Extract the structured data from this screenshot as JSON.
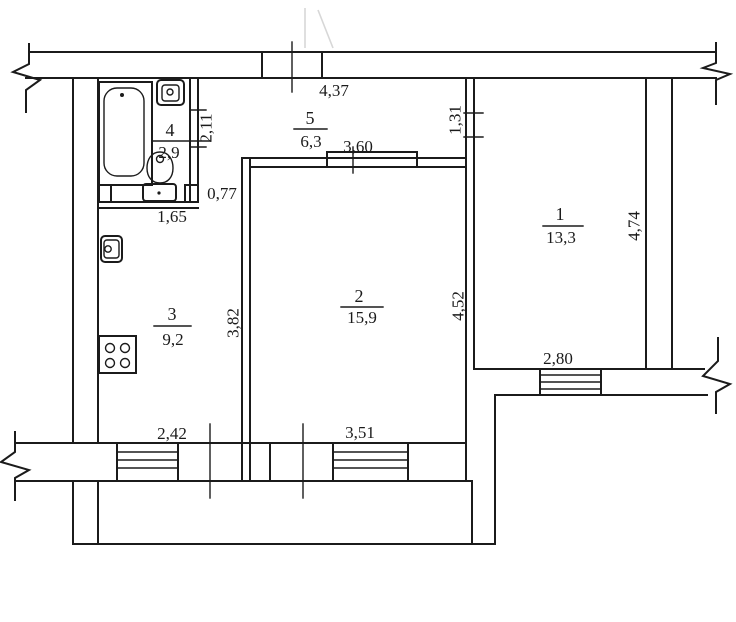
{
  "plan": {
    "type": "apartment-floor-plan",
    "rooms": {
      "room1": {
        "number": "1",
        "area": "13,3"
      },
      "room2": {
        "number": "2",
        "area": "15,9"
      },
      "room3": {
        "number": "3",
        "area": "9,2"
      },
      "room4": {
        "number": "4",
        "area": "2,9"
      },
      "room5": {
        "number": "5",
        "area": "6,3"
      }
    },
    "dims": {
      "entry_width": "4,37",
      "hall_room2_opening": "3,60",
      "room1_door": "1,31",
      "room1_depth": "4,74",
      "room1_window": "2,80",
      "room2_depth": "4,52",
      "room2_window": "3,51",
      "kitchen_depth": "3,82",
      "kitchen_window": "2,42",
      "bath_depth": "2,11",
      "bath_passage": "0,77",
      "bath_width": "1,65"
    },
    "fixtures": {
      "bathtub": "bathtub-icon",
      "bath_sink": "washbasin-icon",
      "toilet": "toilet-icon",
      "kitchen_sink": "kitchen-sink-icon",
      "stove": "stove-icon"
    },
    "colors": {
      "line": "#1b1b1b",
      "background": "#ffffff",
      "faint_mark": "#d7d7d7"
    }
  }
}
